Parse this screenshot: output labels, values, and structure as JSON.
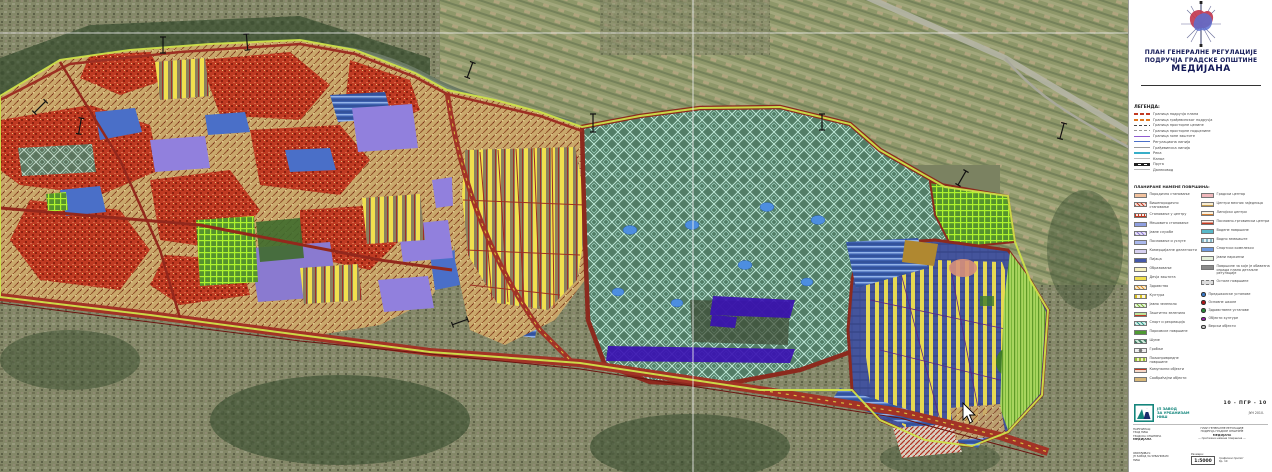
{
  "panel": {
    "title_line1": "ПЛАН ГЕНЕРАЛНЕ РЕГУЛАЦИЈЕ",
    "title_line2": "ПОДРУЧЈА ГРАДСКЕ ОПШТИНЕ",
    "title_line3": "МЕДИЈАНА",
    "legend_heading": "ЛЕГЕНДА:",
    "lines": [
      {
        "sym": "reddash",
        "label": "Граница подручја плана"
      },
      {
        "sym": "orangedash",
        "label": "Граница грађевинског подручја"
      },
      {
        "sym": "darkdash",
        "label": "Граница просторне целине"
      },
      {
        "sym": "graydash",
        "label": "Граница просторне подцелине"
      },
      {
        "sym": "purpleline",
        "label": "Граница зоне заштите"
      },
      {
        "sym": "blueline",
        "label": "Регулациона линија"
      },
      {
        "sym": "grayline",
        "label": "Грађевинска линија"
      },
      {
        "sym": "cyanline",
        "label": "Река"
      },
      {
        "sym": "thinline",
        "label": "Канал"
      },
      {
        "sym": "rail",
        "label": "Пруга"
      },
      {
        "sym": "thinline",
        "label": "Далековод"
      }
    ],
    "areas_heading": "ПЛАНИРАНЕ НАМЕНЕ ПОВРШИНА:",
    "areas_left": [
      {
        "swatch": "peach",
        "label": "Породично становање"
      },
      {
        "swatch": "redhatch",
        "label": "Вишепородично становање"
      },
      {
        "swatch": "redgrid",
        "label": "Становање у центру"
      },
      {
        "swatch": "bluelav",
        "label": "Мешовито становање"
      },
      {
        "swatch": "lavhatch",
        "label": "Јавне службе"
      },
      {
        "swatch": "periwinkle",
        "label": "Пословање и услуге"
      },
      {
        "swatch": "lightlav",
        "label": "Комерцијалне делатности"
      },
      {
        "swatch": "navybox",
        "label": "Пијаца"
      },
      {
        "swatch": "paleyellow",
        "label": "Образовање"
      },
      {
        "swatch": "yellow",
        "label": "Дечја заштита"
      },
      {
        "swatch": "orangehatch",
        "label": "Здравство"
      },
      {
        "swatch": "yellowline",
        "label": "Култура"
      },
      {
        "swatch": "palegreenhatch",
        "label": "Јавно зеленило"
      },
      {
        "swatch": "redgreen",
        "label": "Заштитно зеленило"
      },
      {
        "swatch": "tealhatch",
        "label": "Спорт и рекреација"
      },
      {
        "swatch": "green",
        "label": "Парковске површине"
      },
      {
        "swatch": "greendiamond",
        "label": "Шуме"
      },
      {
        "swatch": "circle",
        "label": "Гробље"
      },
      {
        "swatch": "greenyellow",
        "label": "Пољопривредне површине"
      },
      {
        "swatch": "redbar",
        "label": "Комунални објекти"
      },
      {
        "swatch": "tanbar",
        "label": "Саобраћајни објекти"
      }
    ],
    "areas_right": [
      {
        "swatch": "pink",
        "label": "Градски центар"
      },
      {
        "swatch": "tanlines",
        "label": "Центри месних заједница"
      },
      {
        "swatch": "tanlines2",
        "label": "Линијски центри"
      },
      {
        "swatch": "redline",
        "label": "Пословно-трговински центри"
      },
      {
        "swatch": "teal",
        "label": "Водене површине"
      },
      {
        "swatch": "watertex",
        "label": "Водно земљиште"
      },
      {
        "swatch": "blue",
        "label": "Спортски комплекси"
      },
      {
        "swatch": "palepark",
        "label": "Јавни паркинзи"
      },
      {
        "swatch": "gray",
        "label": "Површине за које је обавезна израда плана детаљне регулације"
      },
      {
        "swatch": "lightgray",
        "label": "Остале површине"
      }
    ],
    "dots": [
      {
        "color": "#3a7ac8",
        "label": "Предшколске установе"
      },
      {
        "color": "#b01818",
        "label": "Основне школе"
      },
      {
        "color": "#2a8a3a",
        "label": "Здравствене установе"
      },
      {
        "color": "#9a20b0",
        "label": "Објекти културе"
      },
      {
        "color": "#c8c8c8",
        "label": "Верски објекти"
      }
    ],
    "logo": {
      "line1": "ЈП ЗАВОД",
      "line2": "ЗА УРБАНИЗАМ",
      "line3": "НИШ"
    },
    "titleblock": {
      "code": "10 - ПГР - 10",
      "date": "ЈУН 2010.",
      "client_heading": "НАРУЧИЛАЦ:",
      "client_line1": "ГРАД НИШ",
      "client_line2": "ГРАДСКА ОПШТИНА",
      "client_line3": "МЕДИЈАНА",
      "center_line1": "ПЛАН ГЕНЕРАЛНЕ РЕГУЛАЦИЈЕ",
      "center_line2": "ПОДРУЧЈА ГРАДСКЕ ОПШТИНЕ",
      "center_line3": "МЕДИЈАНА",
      "center_line4": "— претежна намена површина —",
      "author_heading": "ОБРАЂИВАЧ:",
      "author_line1": "ЈП ЗАВОД ЗА УРБАНИЗАМ",
      "author_line2": "НИШ",
      "scale_label": "Размера:",
      "scale": "1:5000",
      "side_line1": "графички прилог",
      "side_line2": "бр. 10"
    }
  },
  "map": {
    "grid": {
      "vertical_x": 693,
      "horizontal_y": 33
    },
    "cursor": {
      "x": 963,
      "y": 403
    },
    "palette": {
      "aerial_base": "#7b8261",
      "forest": "#47593a",
      "river": "#6b7a64",
      "urban_red": "#bf3a22",
      "mixed_tan": "#c9a86b",
      "housing_yellow": "#f0e04e",
      "greenery_teal": "#527d66",
      "park_green_grid": "#aef32e",
      "public_blue": "#4a6fc8",
      "services_purple": "#9180dd",
      "infrastructure_indigo": "#3a10b4",
      "road_red": "#a23326",
      "boundary_yellow_green": "#cde24a",
      "lobe_navy": "#44549c"
    }
  }
}
